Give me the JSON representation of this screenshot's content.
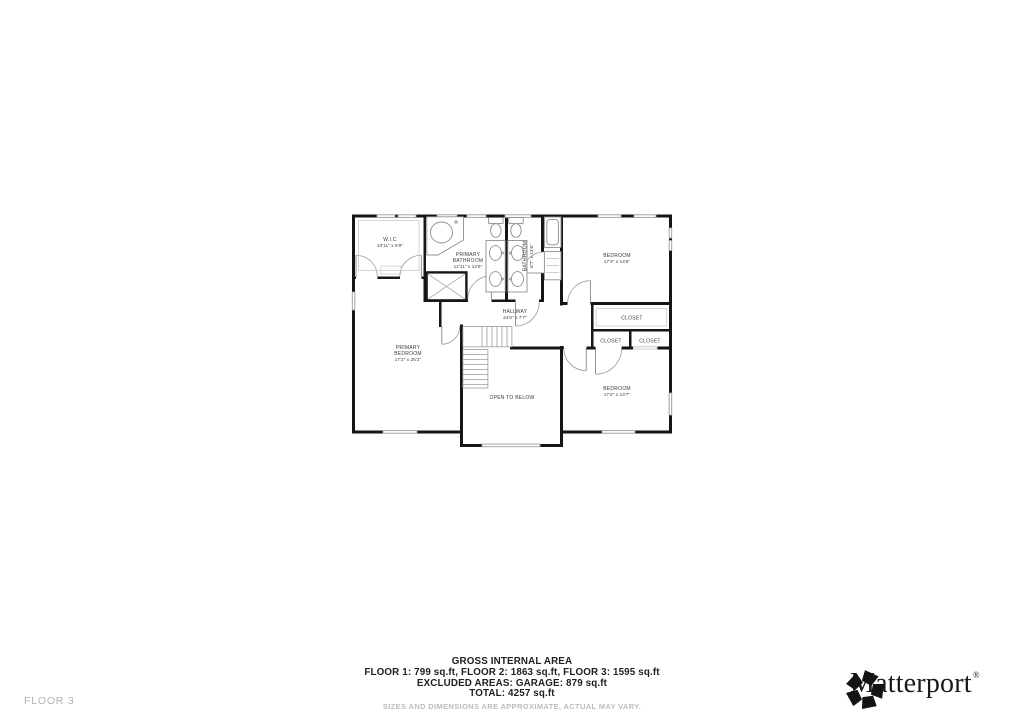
{
  "floor_plan": {
    "rooms": {
      "wic": {
        "name": "W.I.C",
        "dims": "10'11\" x 9'9\""
      },
      "primary_bathroom": {
        "name_line1": "PRIMARY",
        "name_line2": "BATHROOM",
        "dims": "12'11\" x 13'6\""
      },
      "bathroom": {
        "name": "BATHROOM",
        "dims": "8'7\" x 13'6\""
      },
      "bedroom_top": {
        "name": "BEDROOM",
        "dims": "17'3\" x 14'8\""
      },
      "closet_top": {
        "name": "CLOSET"
      },
      "closet_left": {
        "name": "CLOSET"
      },
      "closet_right": {
        "name": "CLOSET"
      },
      "bedroom_bottom": {
        "name": "BEDROOM",
        "dims": "17'2\" x 13'7\""
      },
      "primary_bedroom": {
        "name_line1": "PRIMARY",
        "name_line2": "BEDROOM",
        "dims": "17'2\" x 25'2\""
      },
      "hallway": {
        "name": "HALLWAY",
        "dims": "24'6\" x 7'7\""
      },
      "open_to_below": {
        "name": "OPEN TO BELOW"
      }
    },
    "colors": {
      "wall": "#161616",
      "fixture": "#8f8f8f",
      "window": "#9c9c9c",
      "label": "#3a3a3a"
    }
  },
  "summary": {
    "title": "GROSS INTERNAL AREA",
    "floors_line": "FLOOR 1: 799 sq.ft, FLOOR 2: 1863 sq.ft, FLOOR 3: 1595 sq.ft",
    "excluded_line": "EXCLUDED AREAS: GARAGE: 879 sq.ft",
    "total_line": "TOTAL: 4257 sq.ft",
    "disclaimer": "SIZES AND DIMENSIONS ARE APPROXIMATE, ACTUAL MAY VARY."
  },
  "footer": {
    "floor_label": "FLOOR 3",
    "brand": "Matterport",
    "brand_mark": "®"
  }
}
